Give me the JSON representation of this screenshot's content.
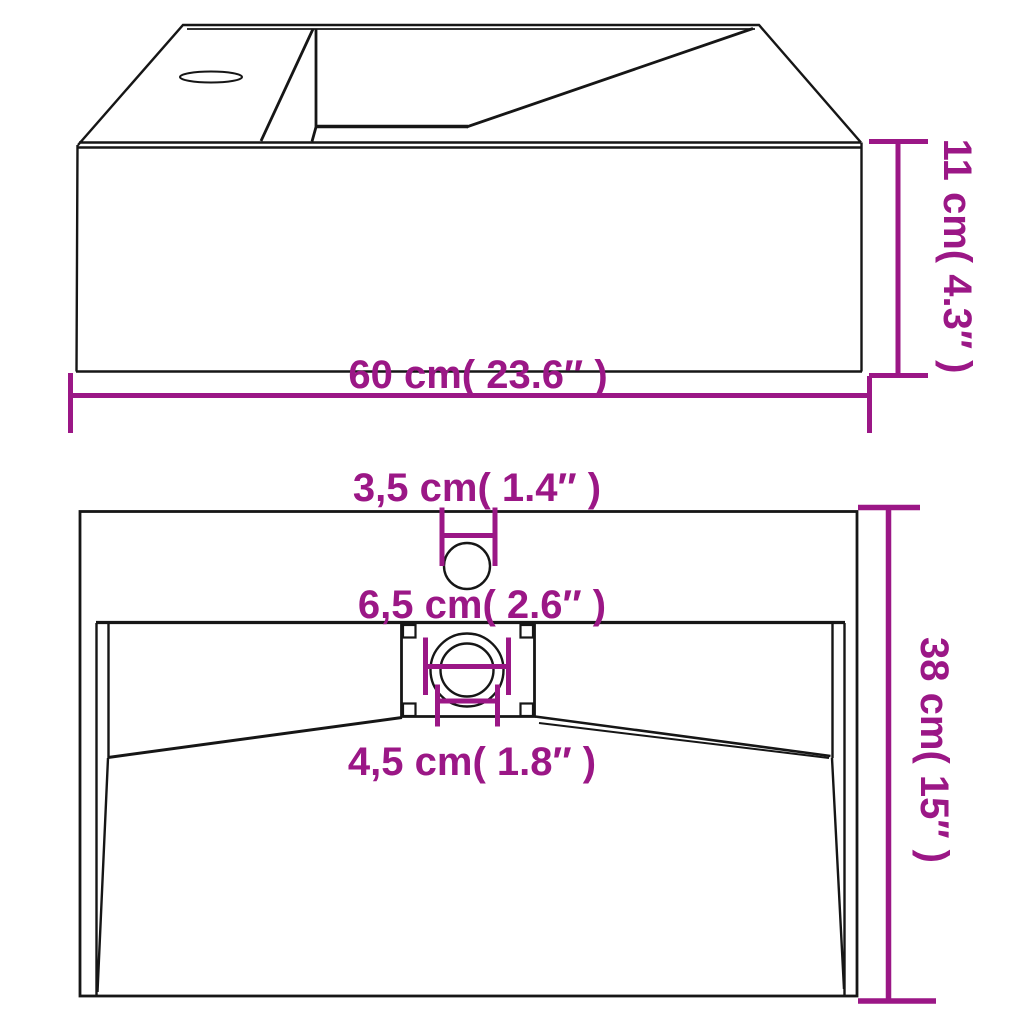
{
  "diagram": {
    "type": "product-dimension-drawing",
    "subject": "wall-mounted basin with faucet hole and drain",
    "colors": {
      "dimension_color": "#9B1786",
      "line_color": "#161616",
      "background": "#FFFFFF"
    },
    "top_view": {
      "width_label": "60 cm( 23.6″ )",
      "height_label": "11 cm( 4.3″ )"
    },
    "front_view": {
      "faucet_hole_label": "3,5 cm( 1.4″ )",
      "drain_recess_label": "6,5 cm( 2.6″ )",
      "drain_hole_label": "4,5 cm( 1.8″ )",
      "depth_label": "38 cm( 15″ )"
    }
  }
}
